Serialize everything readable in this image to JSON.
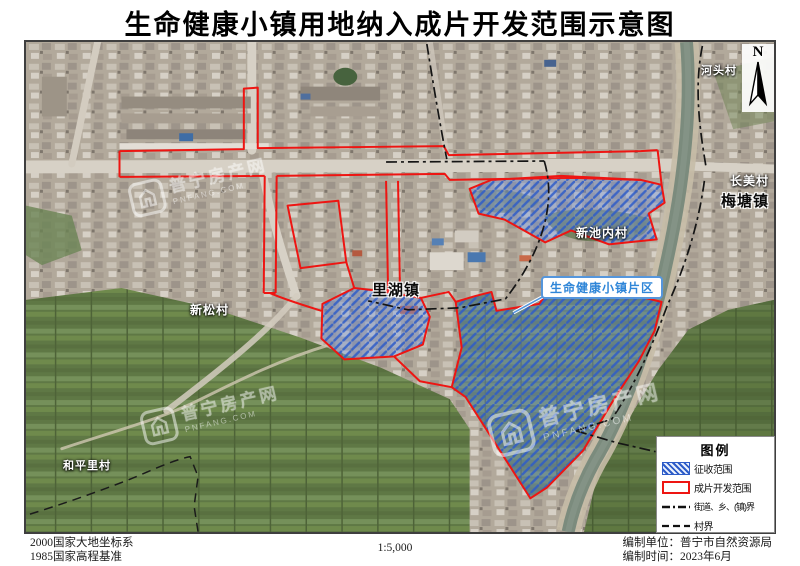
{
  "title": "生命健康小镇用地纳入成片开发范围示意图",
  "north": {
    "label": "N"
  },
  "map_labels": {
    "hetoucun": "河头村",
    "changmeicun": "长美村",
    "meitangzhen": "梅塘镇",
    "xinchineicun": "新池内村",
    "lihuzhen": "里湖镇",
    "xinsongcun": "新松村",
    "hepinglicun": "和平里村",
    "callout": "生命健康小镇片区"
  },
  "watermark": {
    "name": "普宁房产网",
    "domain": "PNFANG.COM"
  },
  "legend": {
    "title": "图例",
    "items": [
      {
        "label": "征收范围",
        "swatch": "blue-hatch"
      },
      {
        "label": "成片开发范围",
        "swatch": "red-outline"
      },
      {
        "label": "街道、乡、(镇)界",
        "swatch": "dash-dot-line"
      },
      {
        "label": "村界",
        "swatch": "dashed-line"
      }
    ]
  },
  "footer": {
    "datum_line1": "2000国家大地坐标系",
    "datum_line2": "1985国家高程基准",
    "scale": "1:5,000",
    "credit_line1": "编制单位：普宁市自然资源局",
    "credit_line2": "编制时间：2023年6月"
  },
  "colors": {
    "development_outline_red": "#ee1512",
    "expropriation_blue": "#2d5cc8",
    "callout_blue": "#2f86d8",
    "river_green": "#7b8b7d",
    "field_green": "#5f7845",
    "boundary_black": "#151515"
  }
}
